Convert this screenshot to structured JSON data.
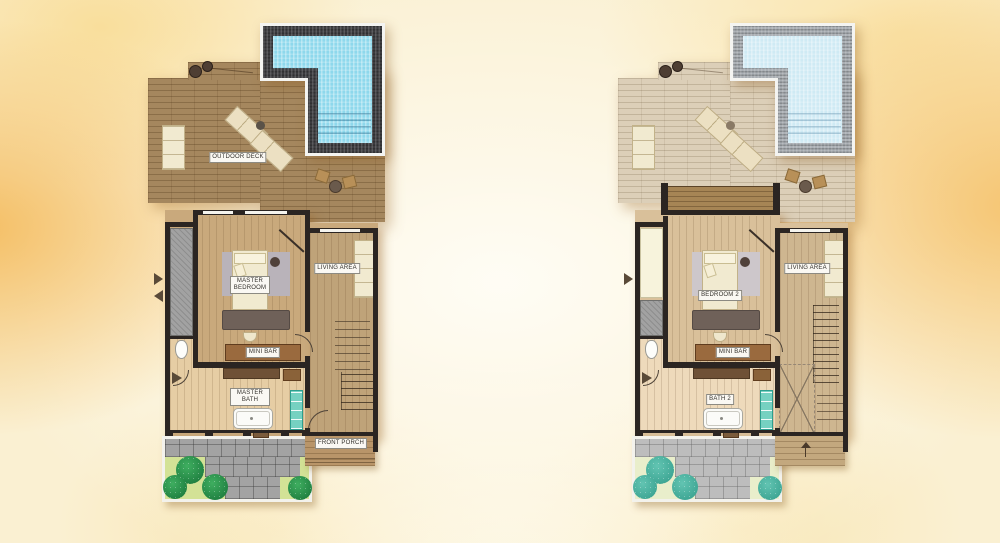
{
  "scene": {
    "type": "pool-villa-floor-plan-pair",
    "background_style": "yellow-orange watercolor wash",
    "left_plan_id": "master-suite-level",
    "right_plan_id": "bedroom-2-level"
  },
  "palette": {
    "deck_wood": "#a5875e",
    "faded_deck_wood": "#dccfb8",
    "pool_water": "#8ed8ec",
    "faded_pool_water": "#cfeaf4",
    "pool_mosaic_border": "#3d3d40",
    "wall": "#2b2522",
    "bedroom_floor": "#c9a97c",
    "bath_floor": "#e6cda4",
    "grass": "#d3e296",
    "faded_grass": "#e9eecb",
    "bush_green": "#3fae60",
    "bush_teal": "#62c4b2",
    "pavers": "#a3a3a3",
    "teal_cabinet": "#76d1c1",
    "label_bg": "#faf8f3"
  },
  "plans": [
    {
      "id": "master-suite-level",
      "labels": {
        "outdoor_deck": "OUTDOOR DECK",
        "bedroom": "MASTER BEDROOM",
        "living_area": "LIVING AREA",
        "mini_bar": "MINI BAR",
        "bath": "MASTER BATH",
        "front_porch": "FRONT PORCH"
      }
    },
    {
      "id": "bedroom-2-level",
      "labels": {
        "bedroom": "BEDROOM 2",
        "living_area": "LIVING AREA",
        "mini_bar": "MINI BAR",
        "bath": "BATH 2"
      }
    }
  ]
}
